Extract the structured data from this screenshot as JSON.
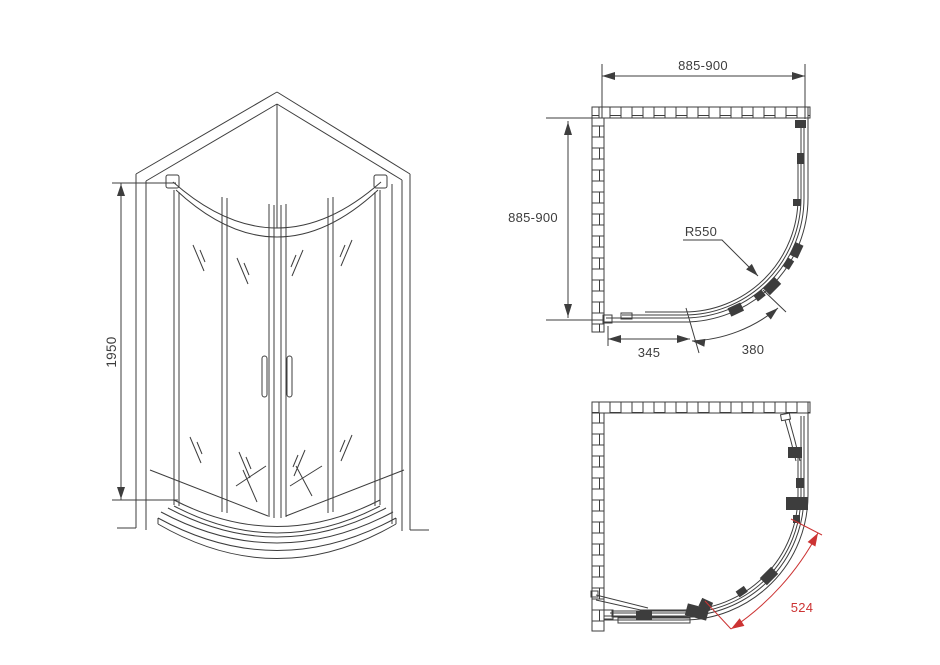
{
  "colors": {
    "line": "#3d3d3d",
    "accent_red": "#cc3333",
    "background": "#ffffff"
  },
  "front_view": {
    "height_label": "1950"
  },
  "plan_closed": {
    "width_label": "885-900",
    "depth_label": "885-900",
    "radius_label": "R550",
    "side_label": "345",
    "arc_label": "380"
  },
  "plan_open": {
    "entry_label": "524"
  }
}
